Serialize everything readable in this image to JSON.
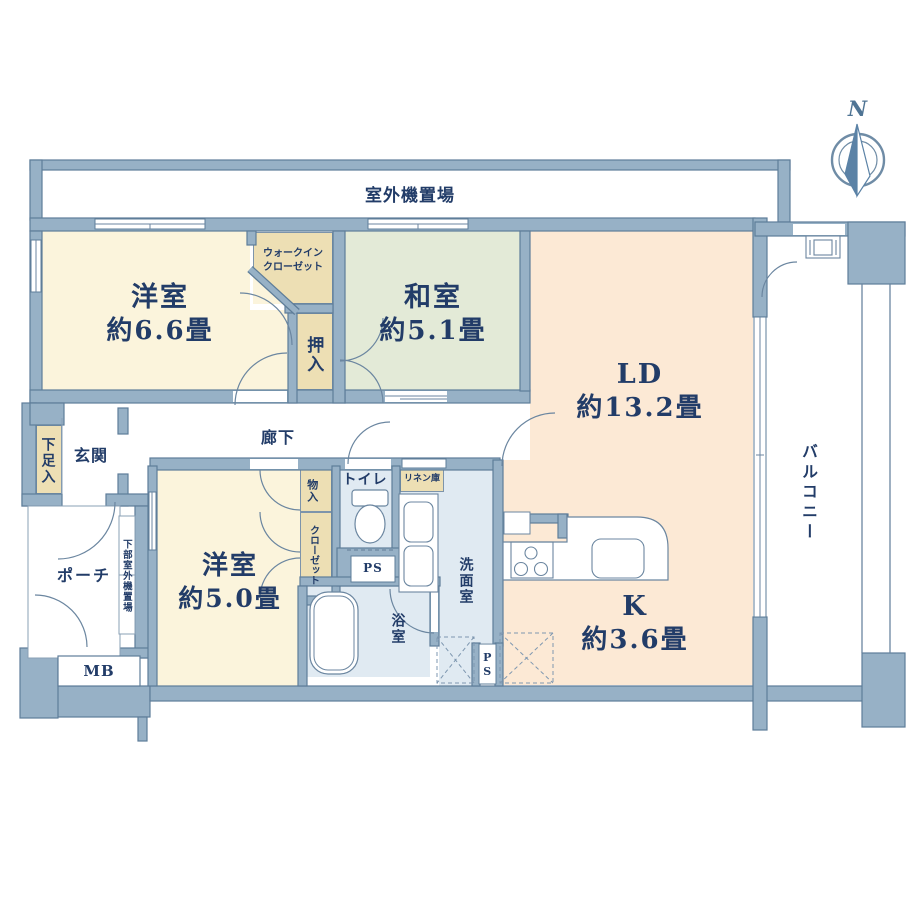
{
  "plan_title": "2LDK-floor-plan",
  "compass": {
    "north_label": "N"
  },
  "palette": {
    "wall": "#97B1C6",
    "wall_outline": "#5E7D99",
    "western_room": "#FBF4DC",
    "closet_tan": "#EDDFB4",
    "japanese_room": "#E3EAD7",
    "living_peach": "#FCE9D5",
    "wet_area": "#E0EAF2",
    "text": "#223C68"
  },
  "rooms": {
    "outdoor_unit": {
      "label": "室外機置場"
    },
    "western1": {
      "name": "洋室",
      "area": "約6.6畳"
    },
    "wic": {
      "line1": "ウォークイン",
      "line2": "クローゼット"
    },
    "oshiire": {
      "label": "押入"
    },
    "japanese": {
      "name": "和室",
      "area": "約5.1畳"
    },
    "ld": {
      "name": "LD",
      "area": "約13.2畳"
    },
    "kitchen": {
      "name": "K",
      "area": "約3.6畳"
    },
    "balcony": {
      "label": "バルコニー"
    },
    "shoe_cabinet": {
      "label": "下足入"
    },
    "entrance": {
      "label": "玄関"
    },
    "corridor": {
      "label": "廊下"
    },
    "porch": {
      "label": "ポーチ"
    },
    "lower_outdoor_unit": {
      "label": "下部室外機置場"
    },
    "meter_box": {
      "label": "MB"
    },
    "western2": {
      "name": "洋室",
      "area": "約5.0畳"
    },
    "storage": {
      "label": "物入"
    },
    "closet": {
      "label": "クローゼット"
    },
    "toilet": {
      "label": "トイレ"
    },
    "linen": {
      "label": "リネン庫"
    },
    "washroom": {
      "label": "洗面室"
    },
    "bathroom": {
      "label": "浴室"
    },
    "pipe_space1": {
      "label": "PS"
    },
    "pipe_space2": {
      "label": "PS"
    }
  }
}
